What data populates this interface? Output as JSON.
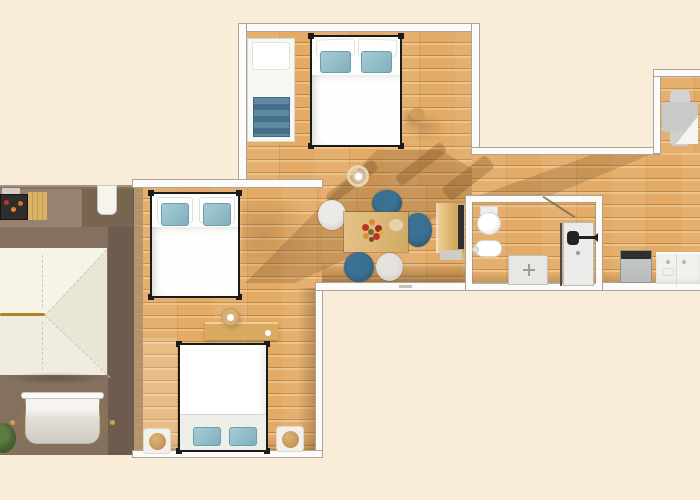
{
  "palette": {
    "bg_cream": "#f9ecd8",
    "wood_base": "#e3ab66",
    "wood_line": "#bd8a4c",
    "wood_hi": "#eec084",
    "terrace_base": "#83705f",
    "terrace_light": "#97826f",
    "terrace_dark": "#6d5b4f",
    "fence": "#b29468",
    "roof_base": "#f0ede0",
    "roof_light": "#f6f3e7",
    "roof_dark": "#eae6d5",
    "roof_ridge": "#b08329",
    "wall_white": "#fcfbf7",
    "wall_edge": "#aaa49a",
    "frame_black": "#1b1b1b",
    "duvet_white": "#fdfdfb",
    "sheet_grey": "#efefea",
    "pillow_teal": "#8cbac6",
    "blanket_blue": "#4e7d97",
    "chair_dark": "#2d5e7c",
    "chair_grey": "#d8d7d3",
    "table_wood": "#ddb87a",
    "flower_red": "#c03428",
    "flower_orange": "#dd8a33",
    "fixture_white": "#ffffff",
    "shower_grey": "#e8e7e3",
    "appliance_grey": "#b9bcbc",
    "appliance_dark": "#2f2f2d",
    "counter_white": "#f2f1ed",
    "lounge_grey": "#c9c9c7",
    "pouf_tan": "#c89a5c",
    "plant_green": "#46602f",
    "shadow_warm": "rgba(112,72,30,0.30)"
  },
  "scene": {
    "type": "apartment-floor-plan",
    "areas": [
      {
        "name": "bedroom-top",
        "objects": [
          "double-bed",
          "single-daybed",
          "side-stool"
        ]
      },
      {
        "name": "bedroom-left",
        "objects": [
          "double-bed"
        ]
      },
      {
        "name": "bedroom-bottom",
        "objects": [
          "double-bed",
          "sideboard",
          "bedside-mat-left",
          "bedside-mat-right",
          "ceiling-light"
        ]
      },
      {
        "name": "living-dining",
        "objects": [
          "dining-table",
          "flower-bouquet",
          "plate",
          "dark-chair-top",
          "dark-chair-right",
          "dark-chair-bottom",
          "grey-chair-left",
          "grey-chair-bottom",
          "pendant-lamp",
          "cabinet"
        ]
      },
      {
        "name": "bathroom",
        "objects": [
          "toilet",
          "bidet",
          "shower-tray",
          "door"
        ]
      },
      {
        "name": "kitchen-right",
        "objects": [
          "dishwasher",
          "sink-counter",
          "lounge-chair"
        ]
      },
      {
        "name": "terrace",
        "objects": [
          "barbecue",
          "wood-table",
          "terrace-door",
          "canopy-roof",
          "hammock",
          "plant"
        ]
      }
    ]
  }
}
